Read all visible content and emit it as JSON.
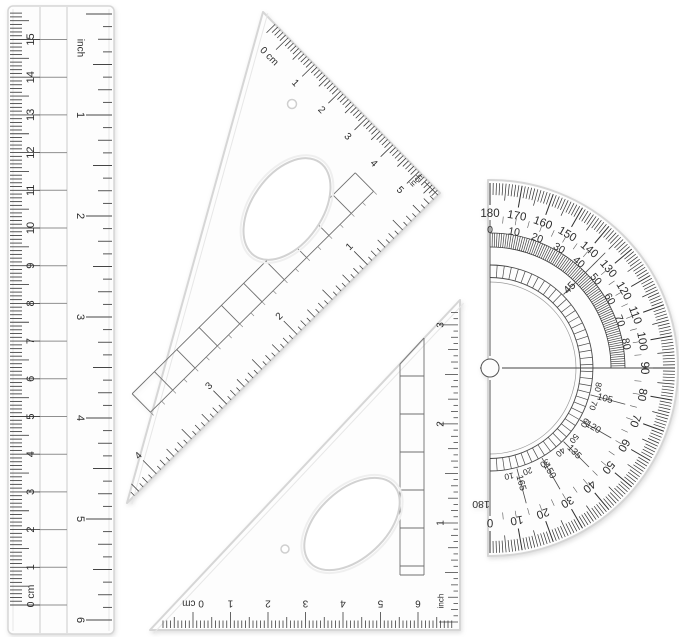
{
  "colors": {
    "background": "#ffffff",
    "plastic_fill": "#fdfdfd",
    "plastic_edge": "#d6d6d6",
    "bevel": "#e7e7e7",
    "ink": "#2d2d2d",
    "ink_light": "#555555",
    "grid": "#8f8f8f"
  },
  "ruler": {
    "cm_scale": {
      "zero_label": "0 cm",
      "numbers": [
        "1",
        "2",
        "3",
        "4",
        "5",
        "6",
        "7",
        "8",
        "9",
        "10",
        "11",
        "12",
        "13",
        "14",
        "15"
      ]
    },
    "inch_scale": {
      "label": "inch",
      "numbers": [
        "1",
        "2",
        "3",
        "4",
        "5",
        "6"
      ]
    }
  },
  "large_set_square": {
    "cm_scale": {
      "zero_label": "0 cm",
      "numbers": [
        "1",
        "2",
        "3",
        "4",
        "5"
      ]
    },
    "inch_scale": {
      "label": "inch",
      "numbers": [
        "1",
        "2",
        "3",
        "4"
      ]
    }
  },
  "small_set_square": {
    "cm_scale": {
      "zero_label": "0 cm",
      "numbers": [
        "1",
        "2",
        "3",
        "4",
        "5",
        "6"
      ]
    },
    "inch_scale": {
      "label": "inch",
      "numbers": [
        "1",
        "2",
        "3"
      ]
    }
  },
  "protractor": {
    "outer_scale_labels": [
      "180",
      "170",
      "160",
      "150",
      "140",
      "130",
      "120",
      "110",
      "100",
      "90",
      "80",
      "70",
      "60",
      "50",
      "40",
      "30",
      "20",
      "10",
      "0"
    ],
    "inner_scale_labels": [
      "0",
      "10",
      "20",
      "30",
      "40",
      "50",
      "60",
      "70",
      "80"
    ],
    "diagonal_labels": [
      "45",
      "105",
      "120",
      "135",
      "150",
      "165",
      "180"
    ],
    "fine_scale_labels": [
      "80",
      "70",
      "60",
      "50",
      "40",
      "30",
      "20",
      "10"
    ]
  }
}
